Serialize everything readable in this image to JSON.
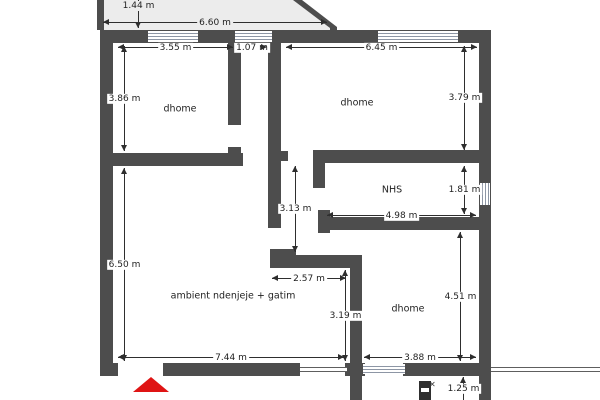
{
  "colors": {
    "background": "#ffffff",
    "wall": "#4d4d4d",
    "balcony": "#ececec",
    "window_line": "#8d96a5",
    "dimension": "#2e2e2e",
    "text": "#1f1f1f",
    "entrance": "#df1414"
  },
  "rooms": {
    "room_top_left": "dhome",
    "room_top_right": "dhome",
    "bathroom": "NHS",
    "living_kitchen": "ambient ndenjeje + gatim",
    "room_bottom_right": "dhome"
  },
  "dimensions": {
    "balcony_depth": "1.44 m",
    "balcony_width": "6.60 m",
    "room_top_left_width": "3.55 m",
    "corridor_width": "1.07 m",
    "room_top_right_width": "6.45 m",
    "room_top_left_height": "3.86 m",
    "room_top_right_height": "3.79 m",
    "bathroom_height": "1.81 m",
    "hall_height": "3.13 m",
    "bathroom_width": "4.98 m",
    "living_height": "6.50 m",
    "kitchen_nook_width": "2.57 m",
    "kitchen_nook_height": "3.19 m",
    "room_bottom_right_height": "4.51 m",
    "living_width": "7.44 m",
    "room_bottom_right_width": "3.88 m",
    "entry_width": "1.25 m"
  },
  "markers": {
    "door_mark": "✕"
  }
}
